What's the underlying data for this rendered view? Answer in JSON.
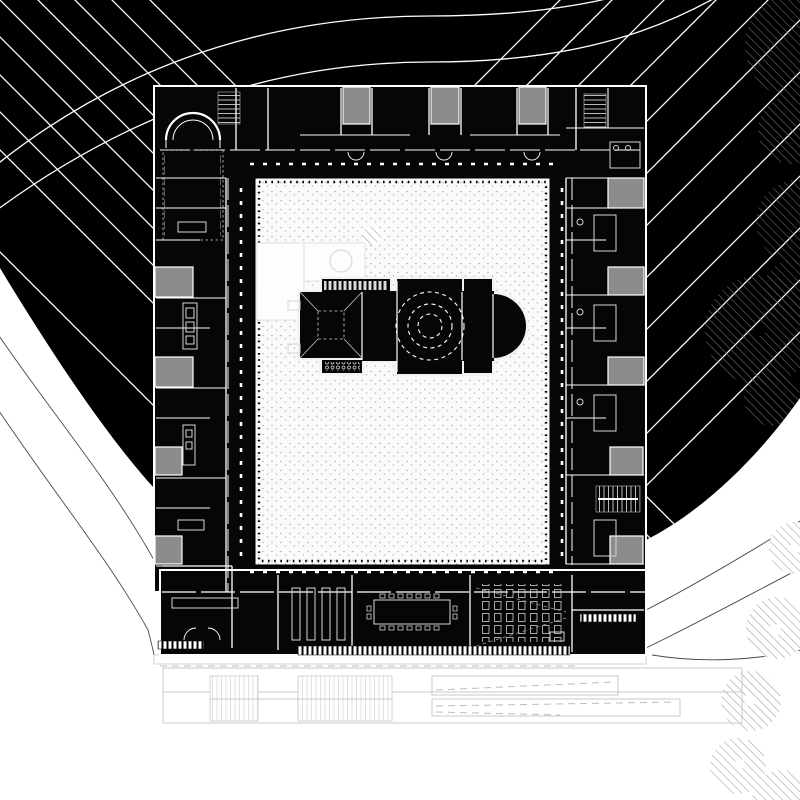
{
  "drawing": {
    "kind_label": "",
    "colors": {
      "paper": "#ffffff",
      "ink": "#000000",
      "building_ink": "#060606",
      "room_gray": "#8c8c8c",
      "contour_on_dark": "#ffffff",
      "contour_on_light": "#4a4a4a",
      "site_line": "#c9c9c9",
      "stipple_dot": "#b3b3ae",
      "tree_hatch_dark": "#707070",
      "tree_hatch_light": "#9c9c9c",
      "detail_line": "#d9d9d9",
      "courtyard_fill": "#fafaf8"
    }
  }
}
